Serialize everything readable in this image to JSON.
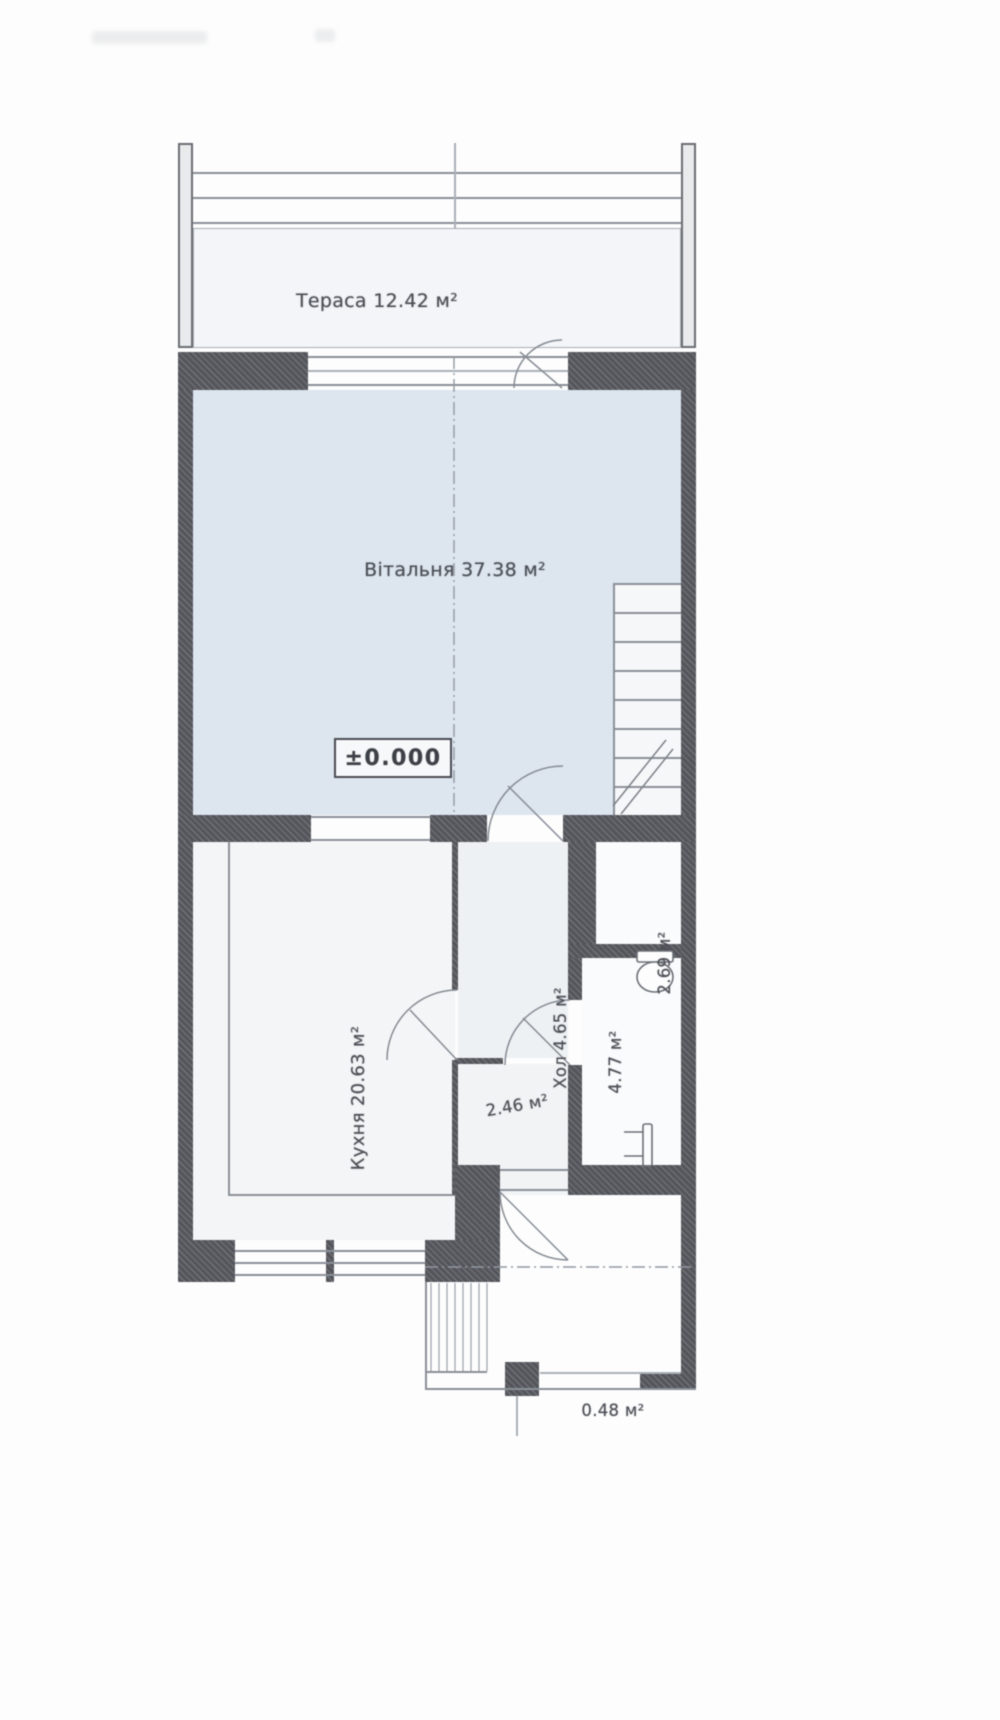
{
  "plan": {
    "elevation_mark": "±0.000",
    "labels": {
      "terrace": "Тераса 12.42 м²",
      "living": "Вітальня 37.38 м²",
      "kitchen": "Кухня 20.63 м²",
      "hall": "Хол 4.65 м²",
      "wc": "2.69 м²",
      "bath": "4.77 м²",
      "vestibule": "2.46 м²",
      "porch": "0.48 м²"
    },
    "colors": {
      "living_fill": "#dde5ef",
      "terrace_fill": "#f3f5f8",
      "kitchen_fill": "#f4f5f6",
      "wall": "#54565c",
      "thin_line": "#8a9098",
      "text": "#4b4e55"
    }
  }
}
